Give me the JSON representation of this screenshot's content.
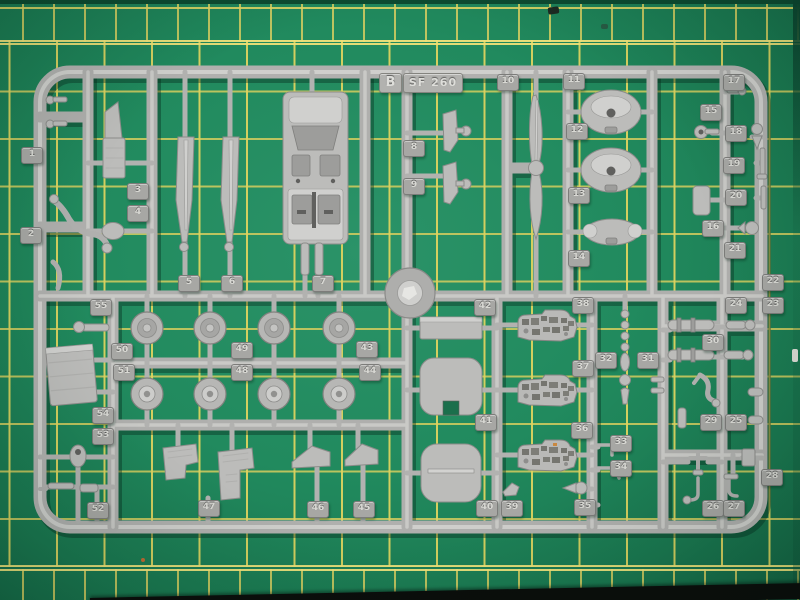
{
  "scene": {
    "type": "photograph",
    "subject": "Injection-molded grey polystyrene model kit sprue (runner B) of an SF 260 aircraft kit lying on a green self-healing cutting mat with yellow grid",
    "sprue": {
      "letter_label": "B",
      "kit_label": "SF 260",
      "plastic_color": "#b4b4b2",
      "part_count": 55,
      "notable_parts": [
        "cockpit tub",
        "two blade parts",
        "two-blade propeller",
        "engine bulkheads",
        "eight wheel halves",
        "three instrument panels",
        "two fuselage bulkheads",
        "seats",
        "landing gear legs"
      ]
    },
    "mat": {
      "color": "#1f8a5e",
      "grid_color": "#dcd35f",
      "edge_color": "#0c4c31",
      "stripe_color": "#0b0d0b"
    },
    "part_tags": [
      {
        "n": "1",
        "x": 31,
        "y": 155
      },
      {
        "n": "2",
        "x": 30,
        "y": 235
      },
      {
        "n": "3",
        "x": 137,
        "y": 191
      },
      {
        "n": "4",
        "x": 137,
        "y": 213
      },
      {
        "n": "5",
        "x": 188,
        "y": 283
      },
      {
        "n": "6",
        "x": 231,
        "y": 283
      },
      {
        "n": "7",
        "x": 322,
        "y": 283
      },
      {
        "n": "8",
        "x": 413,
        "y": 148
      },
      {
        "n": "9",
        "x": 413,
        "y": 186
      },
      {
        "n": "10",
        "x": 507,
        "y": 82
      },
      {
        "n": "11",
        "x": 573,
        "y": 81
      },
      {
        "n": "12",
        "x": 576,
        "y": 131
      },
      {
        "n": "13",
        "x": 578,
        "y": 195
      },
      {
        "n": "14",
        "x": 578,
        "y": 258
      },
      {
        "n": "15",
        "x": 710,
        "y": 112
      },
      {
        "n": "16",
        "x": 712,
        "y": 228
      },
      {
        "n": "17",
        "x": 733,
        "y": 82
      },
      {
        "n": "18",
        "x": 735,
        "y": 133
      },
      {
        "n": "19",
        "x": 733,
        "y": 165
      },
      {
        "n": "20",
        "x": 735,
        "y": 197
      },
      {
        "n": "21",
        "x": 734,
        "y": 250
      },
      {
        "n": "22",
        "x": 772,
        "y": 282
      },
      {
        "n": "23",
        "x": 772,
        "y": 305
      },
      {
        "n": "24",
        "x": 735,
        "y": 305
      },
      {
        "n": "25",
        "x": 735,
        "y": 422
      },
      {
        "n": "26",
        "x": 712,
        "y": 508
      },
      {
        "n": "27",
        "x": 733,
        "y": 508
      },
      {
        "n": "28",
        "x": 771,
        "y": 477
      },
      {
        "n": "29",
        "x": 710,
        "y": 422
      },
      {
        "n": "30",
        "x": 712,
        "y": 342
      },
      {
        "n": "31",
        "x": 647,
        "y": 360
      },
      {
        "n": "32",
        "x": 605,
        "y": 360
      },
      {
        "n": "33",
        "x": 620,
        "y": 443
      },
      {
        "n": "34",
        "x": 620,
        "y": 468
      },
      {
        "n": "35",
        "x": 584,
        "y": 507
      },
      {
        "n": "36",
        "x": 581,
        "y": 430
      },
      {
        "n": "37",
        "x": 582,
        "y": 368
      },
      {
        "n": "38",
        "x": 582,
        "y": 305
      },
      {
        "n": "39",
        "x": 511,
        "y": 508
      },
      {
        "n": "40",
        "x": 486,
        "y": 508
      },
      {
        "n": "41",
        "x": 485,
        "y": 422
      },
      {
        "n": "42",
        "x": 484,
        "y": 307
      },
      {
        "n": "43",
        "x": 366,
        "y": 349
      },
      {
        "n": "44",
        "x": 369,
        "y": 372
      },
      {
        "n": "45",
        "x": 363,
        "y": 509
      },
      {
        "n": "46",
        "x": 317,
        "y": 509
      },
      {
        "n": "47",
        "x": 208,
        "y": 508
      },
      {
        "n": "48",
        "x": 241,
        "y": 372
      },
      {
        "n": "49",
        "x": 241,
        "y": 350
      },
      {
        "n": "50",
        "x": 121,
        "y": 351
      },
      {
        "n": "51",
        "x": 123,
        "y": 372
      },
      {
        "n": "52",
        "x": 97,
        "y": 510
      },
      {
        "n": "53",
        "x": 102,
        "y": 436
      },
      {
        "n": "54",
        "x": 102,
        "y": 415
      },
      {
        "n": "55",
        "x": 100,
        "y": 307
      }
    ]
  }
}
